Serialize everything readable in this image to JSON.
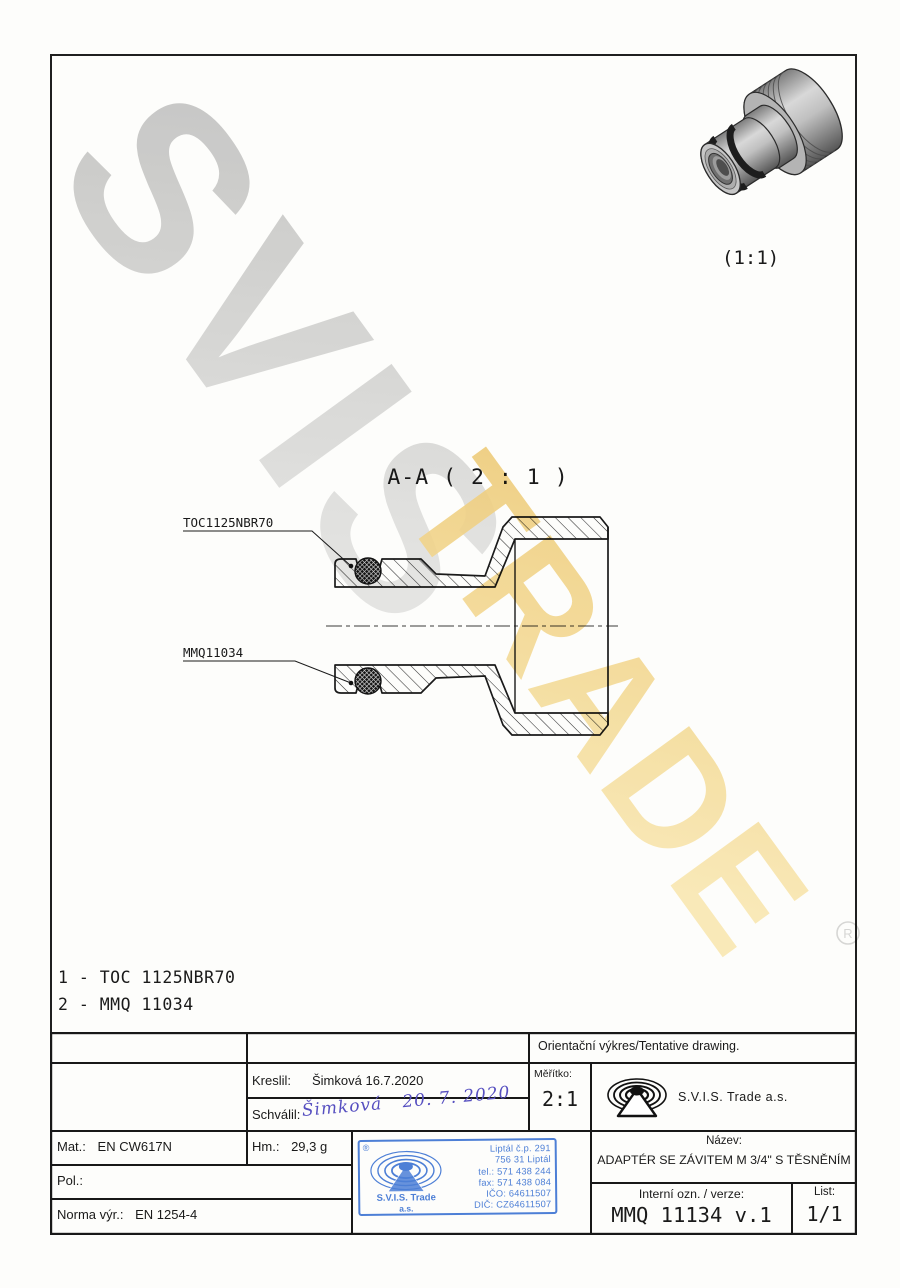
{
  "watermark": {
    "word_gray": "SVIS",
    "word_gold": "TRADE",
    "registered": "®",
    "gray": "#c9c9c9",
    "gold": "#f3d489"
  },
  "view3d": {
    "scale_label": "(1:1)"
  },
  "section": {
    "title": "A-A ( 2 : 1 )",
    "callout_top": "TOC1125NBR70",
    "callout_bottom": "MMQ11034"
  },
  "parts_list": {
    "items": [
      "1 - TOC 1125NBR70",
      "2 - MMQ 11034"
    ]
  },
  "title_block": {
    "orientation_note": "Orientační výkres/Tentative drawing.",
    "kreslil_label": "Kreslil:",
    "kreslil_value": "Šimková 16.7.2020",
    "schvalil_label": "Schválil:",
    "schvalil_signature": "Šimková",
    "schvalil_date": "20. 7. 2020",
    "meritko_label": "Měřítko:",
    "meritko_value": "2:1",
    "company": "S.V.I.S. Trade a.s.",
    "mat_label": "Mat.:",
    "mat_value": "EN CW617N",
    "hm_label": "Hm.:",
    "hm_value": "29,3 g",
    "pol_label": "Pol.:",
    "norma_label": "Norma výr.:",
    "norma_value": "EN 1254-4",
    "nazev_label": "Název:",
    "nazev_value": "ADAPTÉR SE ZÁVITEM M 3/4\" S TĚSNĚNÍM",
    "interni_label": "Interní ozn. / verze:",
    "interni_value": "MMQ 11134 v.1",
    "list_label": "List:",
    "list_value": "1/1"
  },
  "stamp": {
    "registered": "®",
    "company_line1": "S.V.I.S. Trade",
    "company_line2": "a.s.",
    "address": [
      "Liptál č.p. 291",
      "756 31 Liptál",
      "tel.: 571 438 244",
      "fax: 571 438 084",
      "IČO: 64611507",
      "DIČ: CZ64611507"
    ],
    "blue": "#4d7fd6"
  },
  "colors": {
    "line_black": "#1a1a1a",
    "signature_ink": "#564fc0",
    "watermark_gray": "#c9c9c9",
    "watermark_gold": "#f3d489",
    "stamp_blue": "#4d7fd6"
  }
}
